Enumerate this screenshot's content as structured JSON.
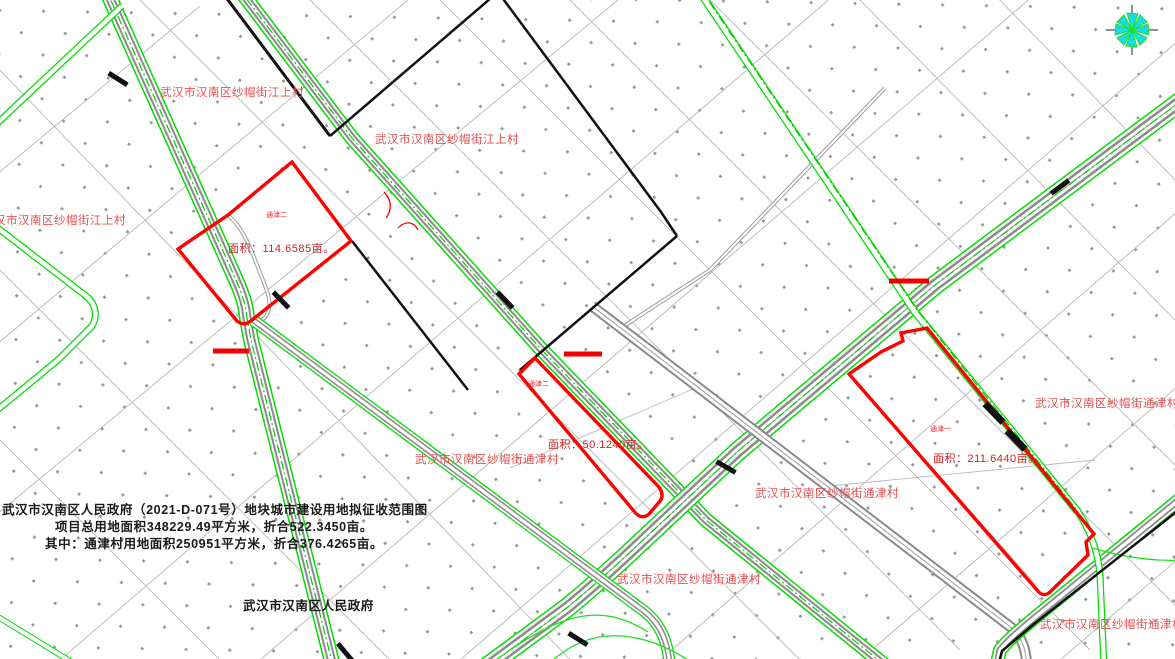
{
  "title_block": {
    "line1": "武汉市汉南区人民政府（2021-D-071号）地块城市建设用地拟征收范围图",
    "line2": "项目总用地面积348229.49平方米，折合522.3450亩。",
    "line3": "其中：通津村用地面积250951平方米，折合376.4265亩。",
    "signature": "武汉市汉南区人民政府"
  },
  "village_labels": [
    {
      "text": "武汉市汉南区纱帽街江上村"
    },
    {
      "text": "武汉市汉南区纱帽街江上村"
    },
    {
      "text": "武汉市汉南区纱帽街江上村"
    },
    {
      "text": "武汉市汉南区纱帽街通津村"
    },
    {
      "text": "武汉市汉南区纱帽街通津村"
    },
    {
      "text": "武汉市汉南区纱帽街通津村"
    },
    {
      "text": "武汉市汉南区纱帽街通津村"
    },
    {
      "text": "武汉市汉南区纱帽街通津村"
    }
  ],
  "parcels": [
    {
      "tag": "通津二",
      "area_label": "面积：114.6585亩。",
      "area_mu": 114.6585
    },
    {
      "tag": "通津二",
      "area_label": "面积：50.1240亩。",
      "area_mu": 50.124
    },
    {
      "tag": "通津一",
      "area_label": "面积：211.6440亩。",
      "area_mu": 211.644
    }
  ],
  "totals": {
    "total_area_sqm": "348229.49",
    "total_area_mu": "522.3450",
    "tongjin_area_sqm": "250951",
    "tongjin_area_mu": "376.4265"
  },
  "compass": {
    "name": "north-compass"
  },
  "colors": {
    "parcel_outline": "#ff0000",
    "road_green": "#00dd00",
    "boundary_black": "#000000",
    "village_label": "#e85050",
    "compass_cyan": "#18dde6",
    "dot_gray": "#969696"
  }
}
